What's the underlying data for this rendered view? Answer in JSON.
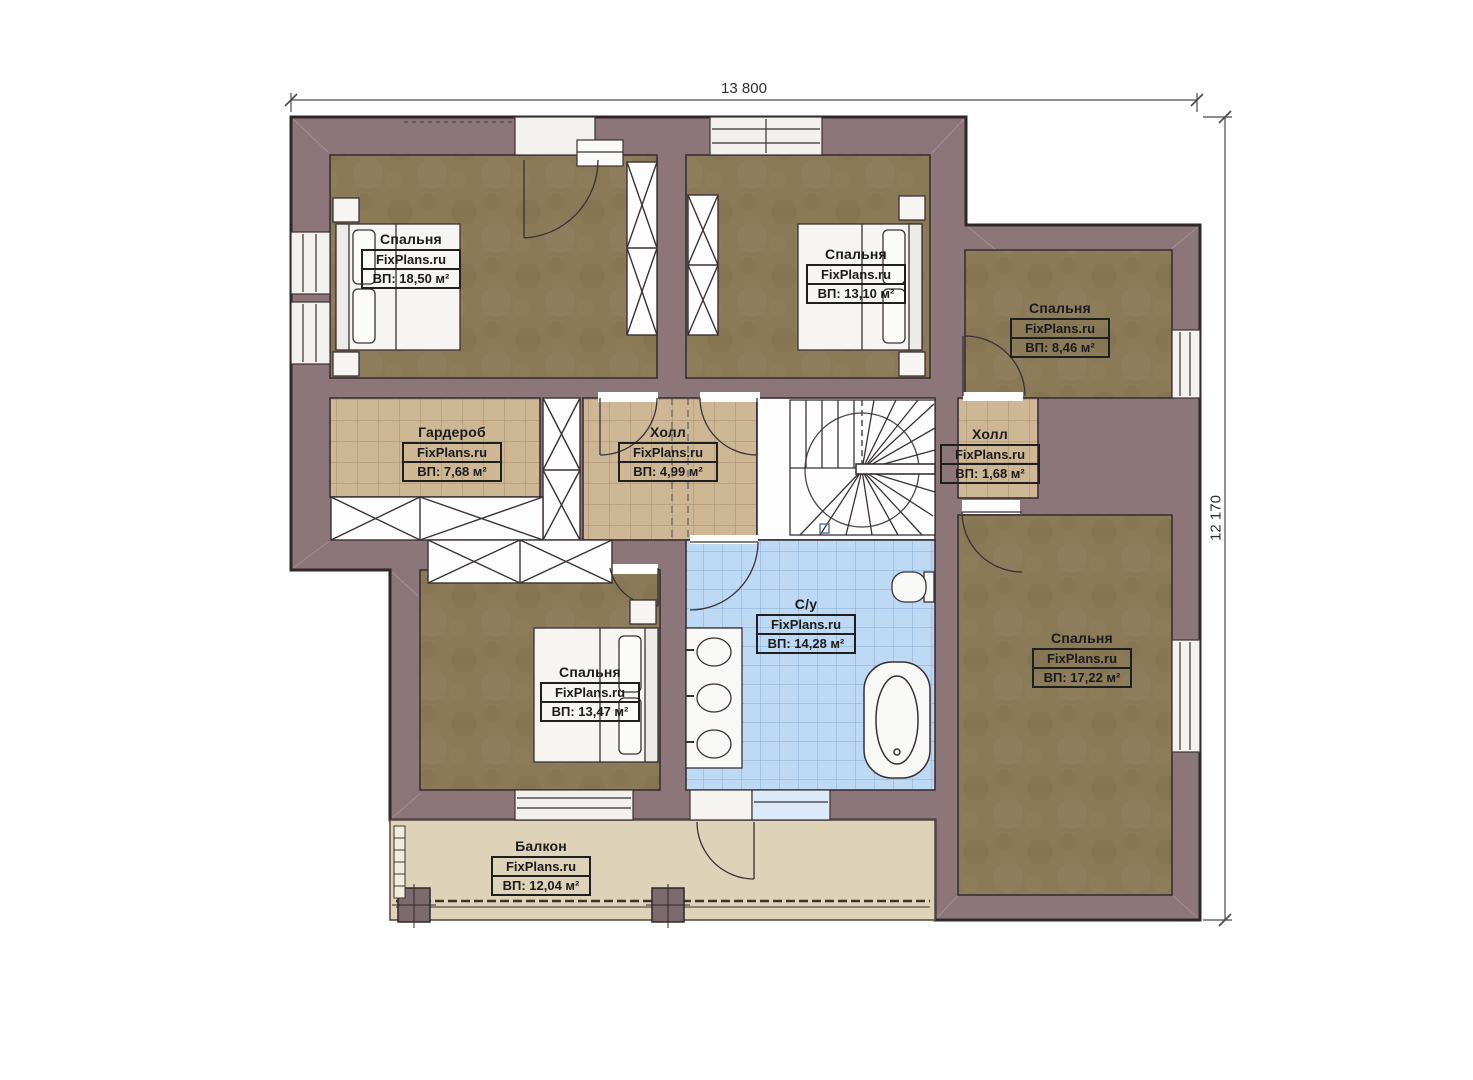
{
  "dimensions": {
    "width_label": "13 800",
    "height_label": "12 170"
  },
  "rooms": [
    {
      "id": "bedroom-1",
      "name": "Спальня",
      "brand": "FixPlans.ru",
      "area": "ВП: 18,50 м²"
    },
    {
      "id": "bedroom-2",
      "name": "Спальня",
      "brand": "FixPlans.ru",
      "area": "ВП: 13,10 м²"
    },
    {
      "id": "bedroom-3",
      "name": "Спальня",
      "brand": "FixPlans.ru",
      "area": "ВП: 8,46 м²"
    },
    {
      "id": "wardrobe",
      "name": "Гардероб",
      "brand": "FixPlans.ru",
      "area": "ВП: 7,68 м²"
    },
    {
      "id": "hall",
      "name": "Холл",
      "brand": "FixPlans.ru",
      "area": "ВП: 4,99 м²"
    },
    {
      "id": "hall-small",
      "name": "Холл",
      "brand": "FixPlans.ru",
      "area": "ВП: 1,68 м²"
    },
    {
      "id": "bathroom",
      "name": "С/у",
      "brand": "FixPlans.ru",
      "area": "ВП: 14,28 м²"
    },
    {
      "id": "bedroom-4",
      "name": "Спальня",
      "brand": "FixPlans.ru",
      "area": "ВП: 13,47 м²"
    },
    {
      "id": "bedroom-5",
      "name": "Спальня",
      "brand": "FixPlans.ru",
      "area": "ВП: 17,22 м²"
    },
    {
      "id": "balcony",
      "name": "Балкон",
      "brand": "FixPlans.ru",
      "area": "ВП: 12,04 м²"
    }
  ],
  "colors": {
    "wall": "#8d767a",
    "bedroom_floor": "#8b7a58",
    "tile_tan": "#cdb795",
    "tile_blue": "#bdd9f4",
    "balcony_floor": "#ded2b8",
    "outline": "#2f282b",
    "label_text": "#1b1b1b"
  }
}
